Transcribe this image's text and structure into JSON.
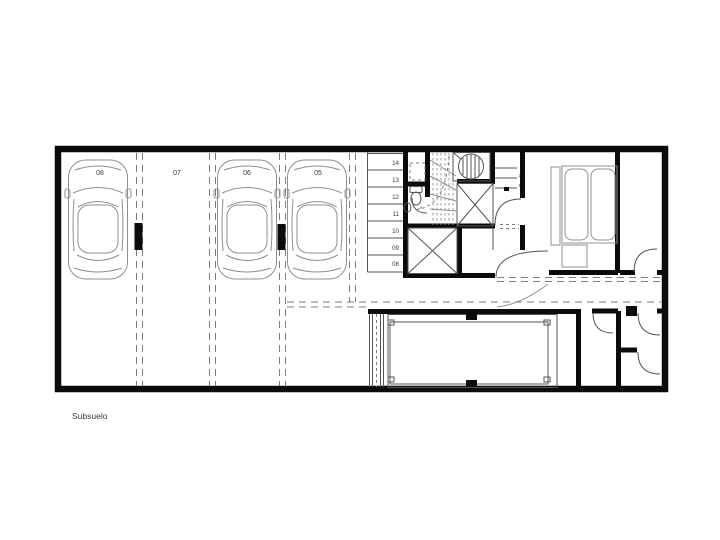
{
  "title": "Subsuelo",
  "colors": {
    "wall": "#0b0b0b",
    "line": "#555555",
    "light": "#909090",
    "dash": "#7d7d7d",
    "label": "#3a3a3a",
    "bg": "#ffffff"
  },
  "parking": {
    "spaces": [
      {
        "label": "08",
        "occupied": true
      },
      {
        "label": "07",
        "occupied": false
      },
      {
        "label": "06",
        "occupied": true
      },
      {
        "label": "05",
        "occupied": true
      }
    ]
  },
  "stairs": {
    "flight_steps": [
      "14",
      "13",
      "12",
      "11",
      "10",
      "09",
      "08"
    ],
    "landing_steps": [
      "2",
      "1"
    ]
  }
}
